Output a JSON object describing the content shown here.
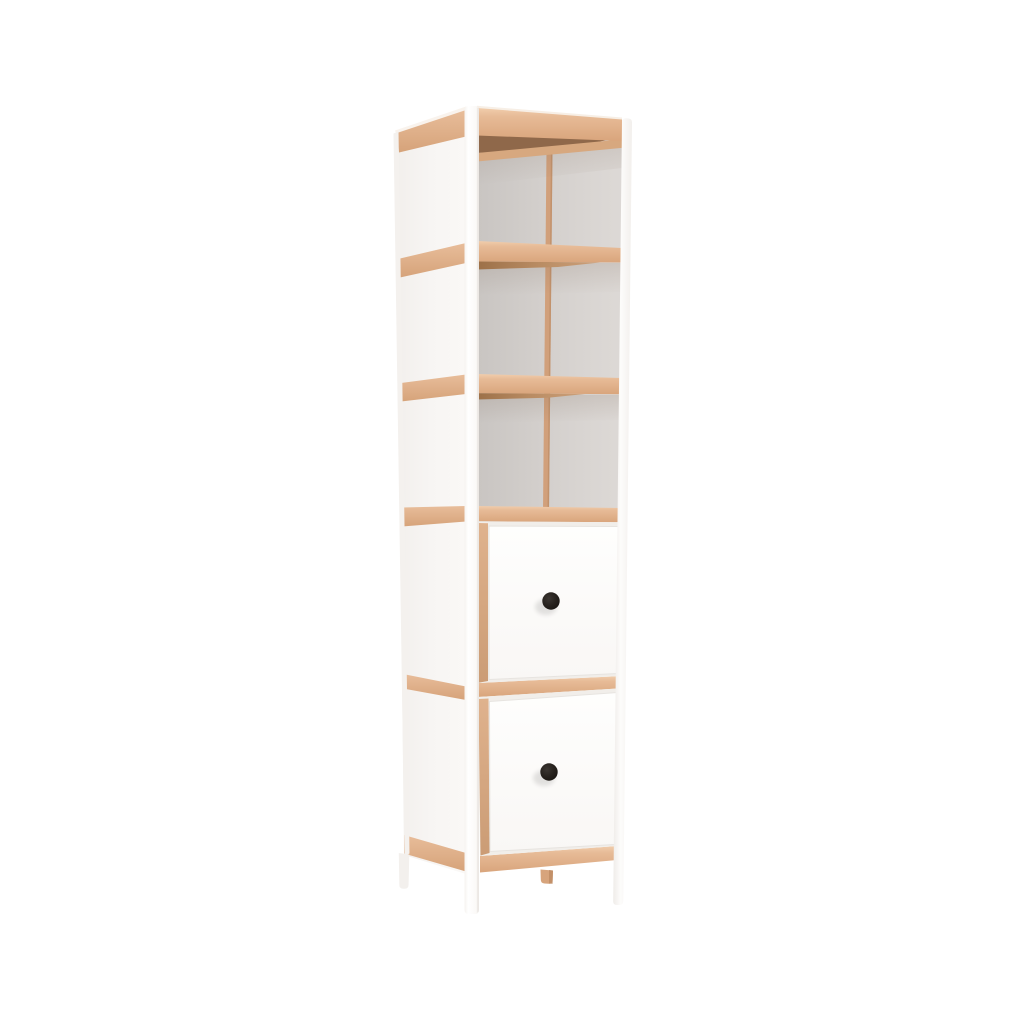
{
  "background_color": "#FFFFFF",
  "object": {
    "name": "shelf-tower",
    "description": "Tall narrow storage tower, 3D render: white frame with light-wood rails, three open shelf compartments on top, two white drawers with round black knobs below, standing on four white legs with a small wood center foot.",
    "shelf_count": 3,
    "drawer_count": 2,
    "knob_count": 2,
    "leg_count": 4
  },
  "colors": {
    "frame_white": "#FDFDFC",
    "side_panel": "#F6F4F2",
    "back_edge_white": "#F4F1EE",
    "wood": "#E3B48F",
    "wood_inner": "#D7A87F",
    "wood_strip": "#D1A07B",
    "wood_strip_shade": "#BC8C66",
    "wood_under": "#B98C63",
    "wood_dark": "#8F684A",
    "wood_peg": "#D7A47C",
    "wood_peg_shade": "#C08D65",
    "interior_gray": "#D3CFCC",
    "interior_gray_dark": "#C8C4C1",
    "drawer_recess": "#F1EEEA",
    "drawer_front": "#FCFBFA",
    "knob_black": "#221E1B"
  }
}
